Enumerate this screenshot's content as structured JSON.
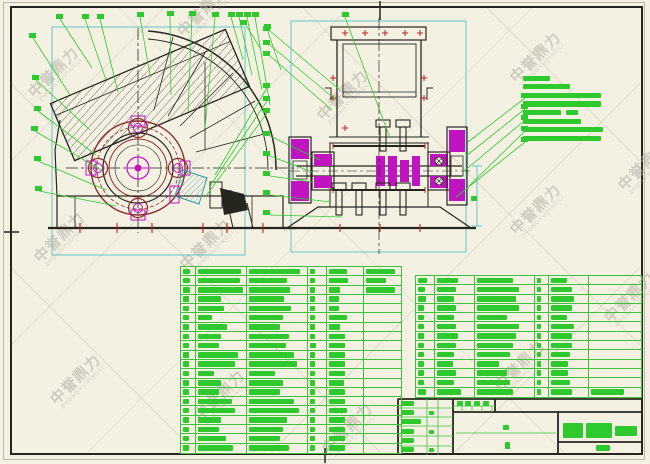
{
  "colors": {
    "sheet_background": "#f4f1e3",
    "annotation_green": "#2dc92d",
    "table_line_green": "#3bc43b",
    "dimension_cyan": "#62c9c9",
    "part_magenta": "#c014c0",
    "rotor_dark_red": "#8c3030",
    "tick_red": "#c02020",
    "outline_dark": "#26261f",
    "watermark_gray": "#b2afa3"
  },
  "watermark": {
    "text": "中誉鼎力",
    "subtext": "ZHONGYUDINGLI",
    "positions": [
      [
        56,
        75
      ],
      [
        205,
        14
      ],
      [
        345,
        98
      ],
      [
        538,
        60
      ],
      [
        62,
        240
      ],
      [
        208,
        247
      ],
      [
        538,
        212
      ],
      [
        78,
        382
      ],
      [
        222,
        398
      ],
      [
        350,
        431
      ],
      [
        522,
        368
      ],
      [
        632,
        300
      ],
      [
        646,
        168
      ]
    ]
  },
  "tech_notes": {
    "x": 523,
    "y": 74,
    "line_height": 8.6,
    "bar_height": 5.2,
    "lines": [
      [
        27
      ],
      [
        47
      ],
      [
        78
      ],
      [
        78
      ],
      [
        38,
        12
      ],
      [
        58
      ],
      [
        80
      ],
      [
        78
      ]
    ]
  },
  "parts_table_left": {
    "x": 180,
    "y": 266,
    "width": 222,
    "height": 188,
    "row_count": 20,
    "col_widths": [
      15,
      52,
      61,
      19,
      38,
      37
    ],
    "rows": [
      [
        0.7,
        0.92,
        0.9,
        0.4,
        0.55,
        0.88
      ],
      [
        0.7,
        0.9,
        0.68,
        0.4,
        0.6,
        0.6
      ],
      [
        0.7,
        0.95,
        0.72,
        0.4,
        0.35,
        0.9
      ],
      [
        0.6,
        0.5,
        0.62,
        0.35,
        0.3,
        0
      ],
      [
        0.6,
        0.55,
        0.75,
        0.35,
        0.3,
        0
      ],
      [
        0.6,
        0.3,
        0.6,
        0.35,
        0.55,
        0
      ],
      [
        0.6,
        0.62,
        0.55,
        0.35,
        0.35,
        0
      ],
      [
        0.6,
        0.5,
        0.7,
        0.4,
        0.5,
        0
      ],
      [
        0.6,
        0.45,
        0.65,
        0.45,
        0.5,
        0
      ],
      [
        0.6,
        0.85,
        0.8,
        0.4,
        0.5,
        0
      ],
      [
        0.6,
        0.8,
        0.85,
        0.35,
        0.5,
        0
      ],
      [
        0.6,
        0.35,
        0.45,
        0.35,
        0.5,
        0
      ],
      [
        0.6,
        0.5,
        0.6,
        0.4,
        0.45,
        0
      ],
      [
        0.6,
        0.45,
        0.55,
        0.4,
        0.5,
        0
      ],
      [
        0.6,
        0.72,
        0.8,
        0.35,
        0.5,
        0
      ],
      [
        0.6,
        0.78,
        0.88,
        0.4,
        0.55,
        0
      ],
      [
        0.6,
        0.5,
        0.68,
        0.4,
        0.5,
        0
      ],
      [
        0.6,
        0.45,
        0.6,
        0.4,
        0.5,
        0
      ],
      [
        0.6,
        0.6,
        0.55,
        0.4,
        0.5,
        0
      ],
      [
        0.6,
        0.75,
        0.7,
        0.4,
        0.5,
        0
      ]
    ]
  },
  "parts_table_right": {
    "x": 415,
    "y": 275,
    "width": 227,
    "height": 123,
    "row_count": 13,
    "col_widths": [
      19,
      40,
      61,
      14,
      40,
      53
    ],
    "rows": [
      [
        0.65,
        0.6,
        0.65,
        0.35,
        0.45,
        0
      ],
      [
        0.5,
        0.55,
        0.75,
        0.35,
        0.6,
        0
      ],
      [
        0.55,
        0.5,
        0.7,
        0.35,
        0.65,
        0
      ],
      [
        0.4,
        0.55,
        0.75,
        0.35,
        0.6,
        0
      ],
      [
        0.4,
        0.5,
        0.55,
        0.35,
        0.45,
        0
      ],
      [
        0.4,
        0.55,
        0.75,
        0.35,
        0.65,
        0
      ],
      [
        0.4,
        0.6,
        0.7,
        0.35,
        0.6,
        0
      ],
      [
        0.4,
        0.55,
        0.65,
        0.35,
        0.6,
        0
      ],
      [
        0.4,
        0.5,
        0.6,
        0.35,
        0.55,
        0
      ],
      [
        0.4,
        0.45,
        0.4,
        0.35,
        0.5,
        0
      ],
      [
        0.4,
        0.55,
        0.55,
        0.35,
        0.5,
        0
      ],
      [
        0.4,
        0.5,
        0.6,
        0.35,
        0.55,
        0
      ],
      [
        0.55,
        0.7,
        0.65,
        0.35,
        0.6,
        0.7
      ]
    ]
  },
  "title_block": {
    "green_blocks": [
      [
        401,
        401,
        13,
        5
      ],
      [
        401,
        410,
        13,
        5
      ],
      [
        401,
        419,
        20,
        5
      ],
      [
        401,
        429,
        13,
        5
      ],
      [
        401,
        438,
        13,
        5
      ],
      [
        401,
        447,
        13,
        5
      ],
      [
        429,
        411,
        5,
        4
      ],
      [
        429,
        430,
        5,
        4
      ],
      [
        429,
        448,
        5,
        4
      ],
      [
        457,
        401,
        6,
        5
      ],
      [
        465,
        401,
        6,
        5
      ],
      [
        474,
        401,
        6,
        5
      ],
      [
        483,
        401,
        6,
        5
      ],
      [
        503,
        425,
        6,
        5
      ],
      [
        505,
        442,
        5,
        7
      ],
      [
        563,
        423,
        20,
        15
      ],
      [
        586,
        423,
        26,
        15
      ],
      [
        615,
        426,
        22,
        10
      ],
      [
        596,
        445,
        14,
        6
      ],
      [
        471,
        196,
        6,
        5
      ]
    ]
  }
}
